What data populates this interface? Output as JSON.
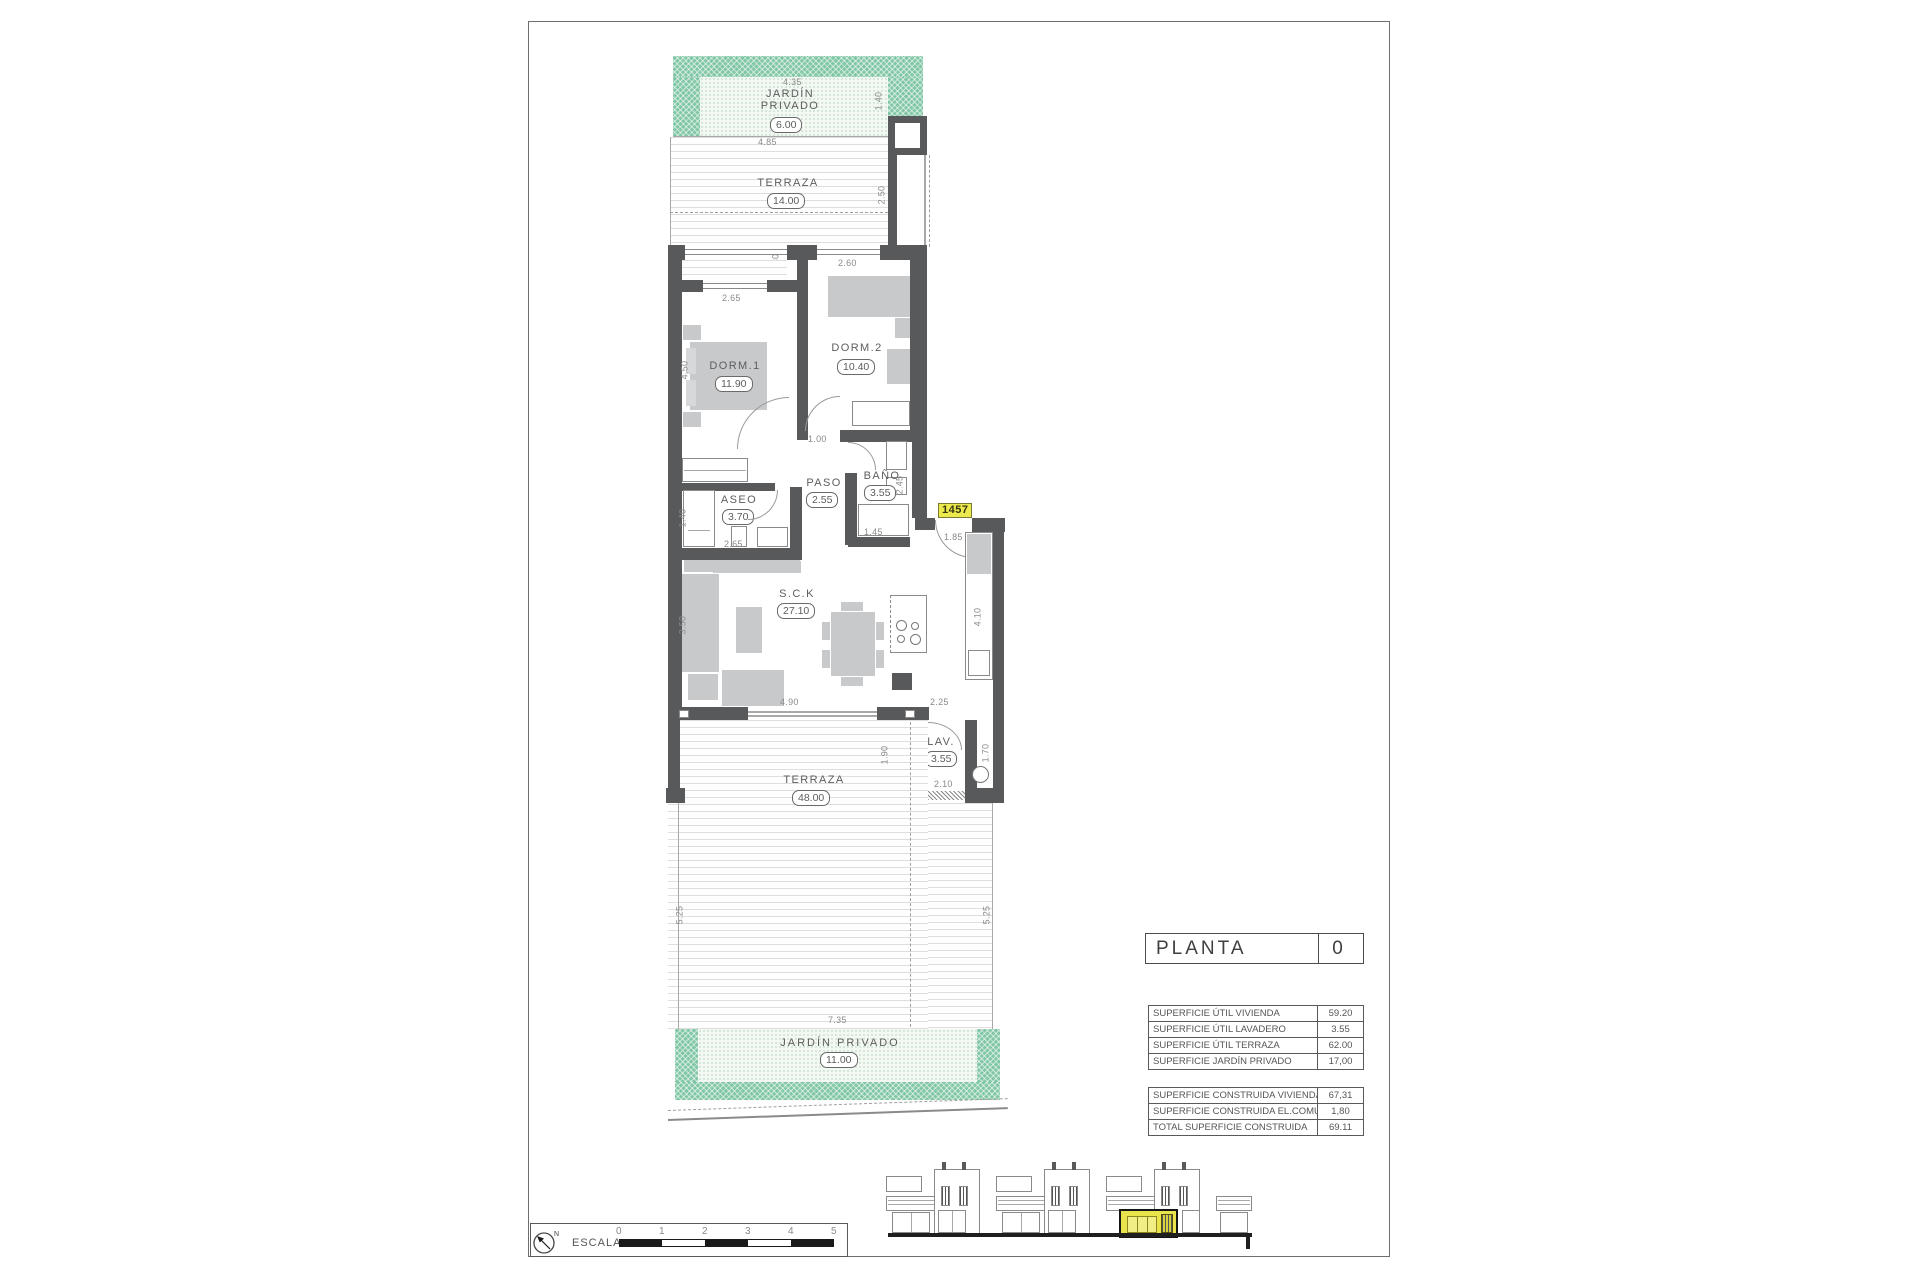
{
  "colors": {
    "wall": "#58595b",
    "garden_green": "#82c7a5",
    "furniture": "#c8c9cb",
    "highlight_yellow": "#ece94e"
  },
  "plan": {
    "unit_tag": "1457",
    "garden_top": {
      "line1": "JARDÍN",
      "line2": "PRIVADO",
      "area": "6.00"
    },
    "terraza_top": {
      "label": "TERRAZA",
      "area": "14.00"
    },
    "rooms": {
      "dorm1": {
        "label": "DORM.1",
        "area": "11.90"
      },
      "dorm2": {
        "label": "DORM.2",
        "area": "10.40"
      },
      "aseo": {
        "label": "ASEO",
        "area": "3.70"
      },
      "paso": {
        "label": "PASO",
        "area": "2.55"
      },
      "bano": {
        "label": "BAÑO",
        "area": "3.55"
      },
      "sck": {
        "label": "S.C.K",
        "area": "27.10"
      },
      "lav": {
        "label": "LAV.",
        "area": "3.55"
      },
      "terraza": {
        "label": "TERRAZA",
        "area": "48.00"
      },
      "jardin": {
        "label": "JARDÍN  PRIVADO",
        "area": "11.00"
      }
    },
    "dims": [
      "4.35",
      "1.40",
      "4.85",
      "2.50",
      "0.80",
      "2.60",
      "2.65",
      "4.50",
      "1.00",
      "1.40",
      "2.65",
      "2.45",
      "1.45",
      "1.85",
      "3.50",
      "4.10",
      "4.90",
      "2.25",
      "1.70",
      "2.10",
      "1.90",
      "5.25",
      "5.25",
      "7.35"
    ]
  },
  "title_block": {
    "label": "PLANTA",
    "floor": "0"
  },
  "areas_table": {
    "group1": [
      {
        "label": "SUPERFICIE ÚTIL VIVIENDA",
        "value": "59.20"
      },
      {
        "label": "SUPERFICIE ÚTIL LAVADERO",
        "value": "3.55"
      },
      {
        "label": "SUPERFICIE ÚTIL TERRAZA",
        "value": "62.00"
      },
      {
        "label": "SUPERFICIE JARDÍN PRIVADO",
        "value": "17,00"
      }
    ],
    "group2": [
      {
        "label": "SUPERFICIE CONSTRUIDA VIVIENDA",
        "value": "67,31"
      },
      {
        "label": "SUPERFICIE CONSTRUIDA EL.COMUNES",
        "value": "1,80"
      },
      {
        "label": "TOTAL SUPERFICIE CONSTRUIDA",
        "value": "69.11"
      }
    ]
  },
  "scale_bar": {
    "label": "ESCALA :",
    "ticks": [
      "0",
      "1",
      "2",
      "3",
      "4",
      "5"
    ],
    "north": "N"
  }
}
